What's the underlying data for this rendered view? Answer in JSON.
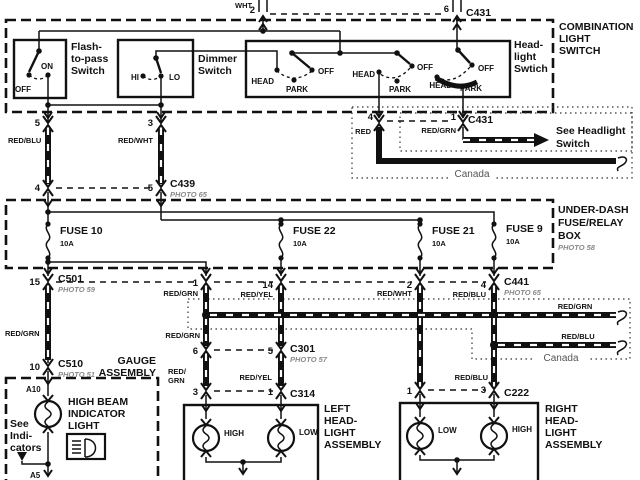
{
  "connectors_top": {
    "wht": "WHT",
    "pin2": "2",
    "pin6": "6",
    "c431": "C431"
  },
  "combination_switch": {
    "title": [
      "COMBINATION",
      "LIGHT",
      "SWITCH"
    ],
    "flash": {
      "title": [
        "Flash-",
        "to-pass",
        "Switch"
      ],
      "off": "OFF",
      "on": "ON"
    },
    "dimmer": {
      "title": [
        "Dimmer",
        "Switch"
      ],
      "hi": "HI",
      "lo": "LO"
    },
    "headlight": {
      "title": [
        "Head-",
        "light",
        "Swtich"
      ],
      "w1": {
        "head": "HEAD",
        "park": "PARK",
        "off": "OFF"
      },
      "w2": {
        "head": "HEAD",
        "park": "PARK",
        "off": "OFF"
      },
      "w3": {
        "head": "HEAD",
        "park": "PARK",
        "off": "OFF"
      }
    },
    "out": {
      "pin5": "5",
      "pin3": "3",
      "red_blu": "RED/BLU",
      "red_wht": "RED/WHT"
    }
  },
  "c439": {
    "name": "C439",
    "photo": "PHOTO 65",
    "pin4": "4",
    "pin5": "5"
  },
  "canada_top": {
    "pin4": "4",
    "red": "RED",
    "pin1": "1",
    "red_grn": "RED/GRN",
    "c431": "C431",
    "see": [
      "See Headlight",
      "Switch"
    ],
    "label": "Canada"
  },
  "underdash": {
    "title": [
      "UNDER-DASH",
      "FUSE/RELAY",
      "BOX"
    ],
    "photo": "PHOTO 58",
    "fuse10": {
      "name": "FUSE 10",
      "amps": "10A"
    },
    "fuse22": {
      "name": "FUSE 22",
      "amps": "10A"
    },
    "fuse21": {
      "name": "FUSE 21",
      "amps": "10A"
    },
    "fuse9": {
      "name": "FUSE 9",
      "amps": "10A"
    }
  },
  "c501": {
    "name": "C501",
    "photo": "PHOTO 59",
    "pin15": "15",
    "pin1": "1",
    "pin14": "14",
    "red_grn": "RED/GRN",
    "red_yel": "RED/YEL"
  },
  "c441": {
    "name": "C441",
    "photo": "PHOTO 65",
    "pin2": "2",
    "pin4": "4",
    "red_wht": "RED/WHT",
    "red_blu": "RED/BLU"
  },
  "canada_band": {
    "red_grn": "RED/GRN",
    "red_blu": "RED/BLU",
    "label": "Canada"
  },
  "left_run": {
    "red_grn": "RED/GRN",
    "pin10": "10",
    "c510": "C510",
    "photo": "PHOTO 51"
  },
  "gauge": {
    "title": [
      "GAUGE",
      "ASSEMBLY"
    ],
    "a10": "A10",
    "a5": "A5",
    "bulb": [
      "HIGH BEAM",
      "INDICATOR",
      "LIGHT"
    ],
    "see": [
      "See",
      "Indi-",
      "cators"
    ]
  },
  "c301": {
    "name": "C301",
    "photo": "PHOTO 57",
    "pin6": "6",
    "pin5": "5",
    "red_grn_above": "RED/GRN",
    "red_grn": [
      "RED/",
      "GRN"
    ],
    "red_yel": "RED/YEL"
  },
  "c314": {
    "name": "C314",
    "pin3": "3",
    "pin1": "1"
  },
  "c222": {
    "name": "C222",
    "pin1": "1",
    "pin3": "3",
    "red_blu": "RED/BLU"
  },
  "left_assembly": {
    "title": [
      "LEFT",
      "HEAD-",
      "LIGHT",
      "ASSEMBLY"
    ],
    "high": "HIGH",
    "low": "LOW"
  },
  "right_assembly": {
    "title": [
      "RIGHT",
      "HEAD-",
      "LIGHT",
      "ASSEMBLY"
    ],
    "low": "LOW",
    "high": "HIGH"
  }
}
